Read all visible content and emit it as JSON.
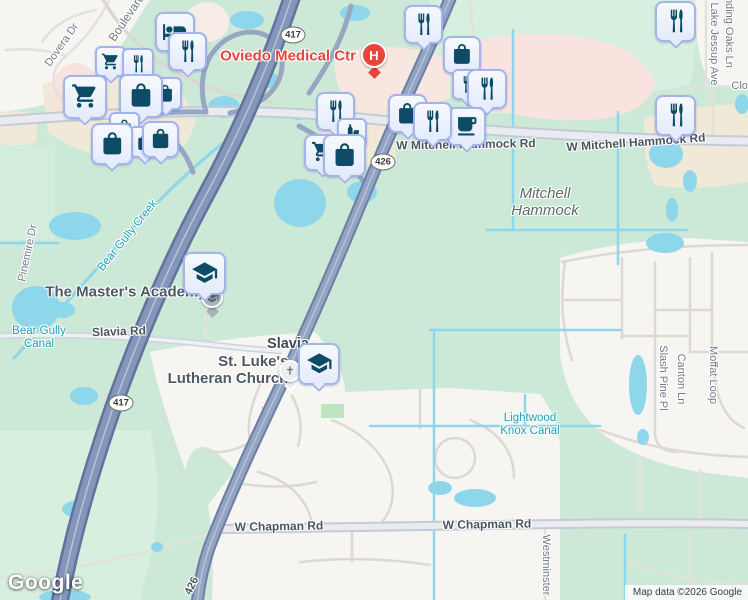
{
  "map": {
    "logo": "Google",
    "attribution": "Map data ©2026 Google",
    "colors": {
      "base_green": "#cbe9d6",
      "urban": "#f6f5f1",
      "commercial_beige": "#f0e9d8",
      "hospital_pink": "#f9e3df",
      "water": "#8ed6ea",
      "toll_road": "#8496ba",
      "highway": "#93a3c2",
      "arterial": "#e9ebf0",
      "pin_fill": "#e9effc",
      "pin_border": "#a3b4ec",
      "pin_icon": "#0d4b66",
      "hospital_red": "#e8453c",
      "label_road": "#4b5561",
      "label_street": "#717b86",
      "label_water": "#1b9fbc",
      "label_poi": "#4d5964",
      "label_area": "#5e6c66"
    },
    "shields": [
      {
        "num": "417",
        "x": 293,
        "y": 35
      },
      {
        "num": "426",
        "x": 383,
        "y": 162
      },
      {
        "num": "417",
        "x": 121,
        "y": 403
      }
    ],
    "labels": [
      {
        "text": "Dovera Dr",
        "x": 62,
        "y": 45,
        "rot": -55,
        "cls": "street"
      },
      {
        "text": "Boulevard",
        "x": 127,
        "y": 18,
        "rot": -56,
        "cls": "street lg"
      },
      {
        "text": "Pinemire Dr",
        "x": 28,
        "y": 253,
        "rot": -78,
        "cls": "street"
      },
      {
        "text": "Winding Oaks Ln",
        "x": 729,
        "y": 26,
        "rot": 90,
        "cls": "street"
      },
      {
        "text": "Lake Jessup Ave",
        "x": 714,
        "y": 44,
        "rot": 90,
        "cls": "street"
      },
      {
        "text": "Clonts",
        "x": 747,
        "y": 86,
        "rot": 0,
        "cls": "street"
      },
      {
        "text": "Slash Pine Pl",
        "x": 663,
        "y": 378,
        "rot": 90,
        "cls": "street"
      },
      {
        "text": "Canton Ln",
        "x": 681,
        "y": 379,
        "rot": 90,
        "cls": "street"
      },
      {
        "text": "Moffat Loop",
        "x": 713,
        "y": 375,
        "rot": 90,
        "cls": "street"
      },
      {
        "text": "Westminster",
        "x": 546,
        "y": 565,
        "rot": 90,
        "cls": "street"
      },
      {
        "text": "W Mitchell Hammock Rd",
        "x": 466,
        "y": 145,
        "rot": -1,
        "cls": "road"
      },
      {
        "text": "W Mitchell Hammock Rd",
        "x": 636,
        "y": 143,
        "rot": -4,
        "cls": "road"
      },
      {
        "text": "Slavia Rd",
        "x": 119,
        "y": 332,
        "rot": -2,
        "cls": "road"
      },
      {
        "text": "W Chapman Rd",
        "x": 279,
        "y": 527,
        "rot": -1,
        "cls": "road"
      },
      {
        "text": "W Chapman Rd",
        "x": 487,
        "y": 525,
        "rot": -1,
        "cls": "road"
      },
      {
        "text": "426",
        "x": 192,
        "y": 586,
        "rot": -64,
        "cls": "road small"
      },
      {
        "text": "Bear Gully Creek",
        "x": 128,
        "y": 236,
        "rot": -51,
        "cls": "water"
      },
      {
        "lines": [
          "Bear Gully",
          "Canal"
        ],
        "x": 39,
        "y": 338,
        "rot": 0,
        "cls": "water"
      },
      {
        "lines": [
          "Lightwood",
          "Knox Canal"
        ],
        "x": 530,
        "y": 425,
        "rot": 0,
        "cls": "water"
      },
      {
        "lines": [
          "Mitchell",
          "Hammock"
        ],
        "x": 545,
        "y": 203,
        "rot": 0,
        "cls": "area"
      },
      {
        "text": "The Master's Academy",
        "x": 126,
        "y": 293,
        "rot": 0,
        "cls": "poi"
      },
      {
        "lines": [
          "St. Luke's",
          "Lutheran Church"
        ],
        "x": 228,
        "y": 371,
        "rot": 0,
        "cls": "poi right"
      },
      {
        "text": "Oviedo Medical Ctr",
        "x": 288,
        "y": 57,
        "rot": 0,
        "cls": "poi med"
      },
      {
        "text": "Slavia",
        "x": 288,
        "y": 344,
        "rot": 0,
        "cls": "locality"
      }
    ],
    "pins": [
      {
        "icon": "lodging",
        "x": 155,
        "y": 12,
        "s": 40
      },
      {
        "icon": "restaurant",
        "x": 168,
        "y": 32,
        "s": 39
      },
      {
        "icon": "cart",
        "x": 95,
        "y": 46,
        "s": 31
      },
      {
        "icon": "restaurant",
        "x": 122,
        "y": 48,
        "s": 32
      },
      {
        "icon": "bag",
        "x": 149,
        "y": 77,
        "s": 33
      },
      {
        "icon": "cart",
        "x": 63,
        "y": 75,
        "s": 44
      },
      {
        "icon": "bag",
        "x": 119,
        "y": 74,
        "s": 44
      },
      {
        "icon": "bag",
        "x": 109,
        "y": 112,
        "s": 31
      },
      {
        "icon": "bag",
        "x": 129,
        "y": 126,
        "s": 32
      },
      {
        "icon": "bag",
        "x": 91,
        "y": 123,
        "s": 42
      },
      {
        "icon": "bag",
        "x": 142,
        "y": 121,
        "s": 37
      },
      {
        "icon": "restaurant",
        "x": 404,
        "y": 5,
        "s": 39
      },
      {
        "icon": "bag",
        "x": 443,
        "y": 36,
        "s": 38
      },
      {
        "icon": "restaurant",
        "x": 452,
        "y": 69,
        "s": 31
      },
      {
        "icon": "restaurant",
        "x": 467,
        "y": 69,
        "s": 40
      },
      {
        "icon": "restaurant",
        "x": 655,
        "y": 1,
        "s": 41
      },
      {
        "icon": "restaurant",
        "x": 655,
        "y": 95,
        "s": 41
      },
      {
        "icon": "restaurant",
        "x": 316,
        "y": 92,
        "s": 39
      },
      {
        "icon": "bar",
        "x": 337,
        "y": 118,
        "s": 30
      },
      {
        "icon": "cart",
        "x": 304,
        "y": 134,
        "s": 37
      },
      {
        "icon": "bag",
        "x": 323,
        "y": 134,
        "s": 43
      },
      {
        "icon": "bag",
        "x": 388,
        "y": 94,
        "s": 39
      },
      {
        "icon": "coffee",
        "x": 447,
        "y": 107,
        "s": 39
      },
      {
        "icon": "restaurant",
        "x": 413,
        "y": 102,
        "s": 39
      },
      {
        "icon": "school",
        "x": 183,
        "y": 252,
        "s": 43
      },
      {
        "icon": "school",
        "x": 298,
        "y": 343,
        "s": 42
      }
    ],
    "markers": [
      {
        "kind": "poi-dot",
        "x": 212,
        "y": 297
      },
      {
        "kind": "church",
        "x": 290,
        "y": 371
      },
      {
        "kind": "hospital",
        "x": 374,
        "y": 55,
        "label": "H"
      }
    ]
  }
}
